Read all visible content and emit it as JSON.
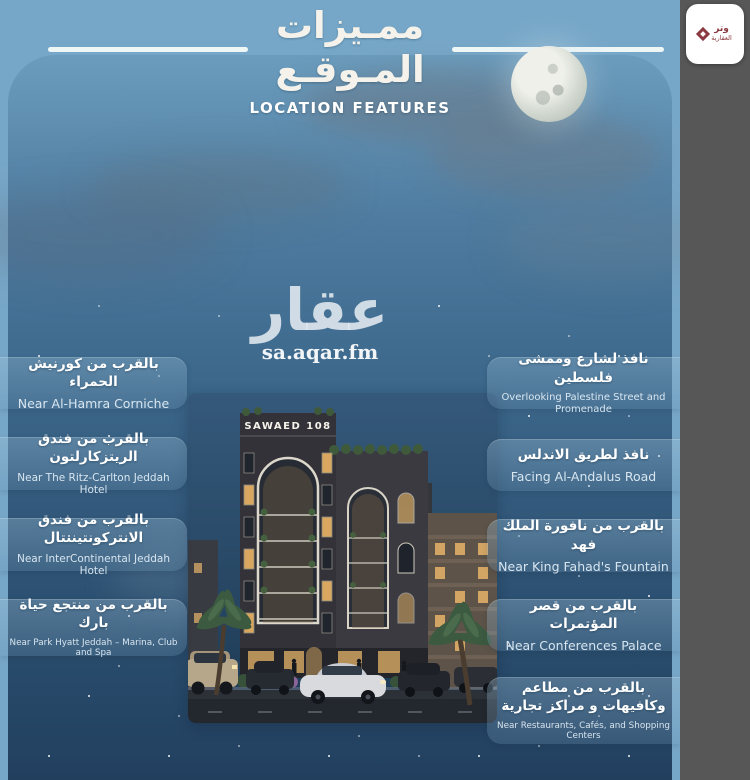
{
  "header": {
    "title_ar_line1": "ممـيزات",
    "title_ar_line2": "المـوقـع",
    "subtitle_en": "LOCATION FEATURES"
  },
  "watermark": {
    "brand_ar": "عقار",
    "domain": "sa.aqar.fm"
  },
  "partner": {
    "line1": "وتر",
    "line2": "العقارية"
  },
  "building": {
    "sign": "SAWAED 108"
  },
  "features_left": [
    {
      "ar": "بالقرب من كورنيش الحمراء",
      "en": "Near Al-Hamra Corniche"
    },
    {
      "ar": "بالقرب من فندق الريتزكارلتون",
      "en": "Near The Ritz-Carlton Jeddah Hotel"
    },
    {
      "ar": "بالقرب من فندق الانتركونتيننتال",
      "en": "Near InterContinental Jeddah Hotel"
    },
    {
      "ar": "بالقرب من منتجع حياة بارك",
      "en": "Near Park Hyatt Jeddah – Marina, Club and Spa"
    }
  ],
  "features_right": [
    {
      "ar": "نافذ لشارع وممشى فلسطين",
      "en": "Overlooking Palestine Street and Promenade"
    },
    {
      "ar": "نافذ لطريق الاندلس",
      "en": "Facing Al-Andalus Road"
    },
    {
      "ar": "بالقرب من نافورة الملك فهد",
      "en": "Near King Fahad's Fountain"
    },
    {
      "ar": "بالقرب من قصر المؤتمرات",
      "en": "Near Conferences Palace"
    },
    {
      "ar": "بالقرب من مطاعم وكافيهات و مراكز تجارية",
      "en": "Near Restaurants, Cafés, and Shopping Centers"
    }
  ],
  "colors": {
    "sky_top": "#77a7c8",
    "panel_deep": "#223f5e",
    "strip": "#575757",
    "maroon": "#8a3a40",
    "window_amber": "#e8b469",
    "title_text": "#f4f2ea"
  }
}
